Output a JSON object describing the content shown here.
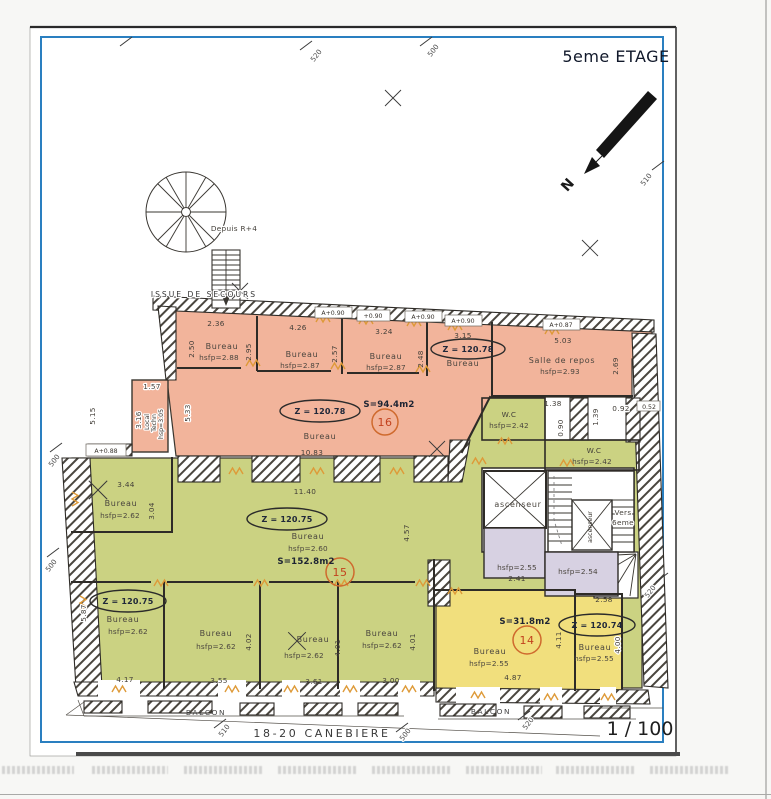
{
  "page": {
    "floor_title": "5eme ETAGE",
    "scale_label": "1 / 100",
    "street_label": "18-20 CANEBIERE",
    "north_label": "N",
    "issue_secours": "ISSUE DE SECOURS",
    "depuis_r4": "Depuis R+4"
  },
  "balcon": {
    "left": "BALCON",
    "right": "BALCON"
  },
  "grid": {
    "top_520": "520",
    "top_500": "500",
    "right_510": "510",
    "right_520": "520",
    "left_500_a": "500",
    "left_500_b": "500",
    "bottom_510": "510",
    "bottom_500": "500",
    "bottom_520": "520"
  },
  "zone16": {
    "z_big": "Z = 120.78",
    "z_small": "Z = 120.78",
    "area": "S=94.4m2",
    "num": "16",
    "big_name": "Bureau",
    "big_width": "10.83",
    "left_dim": "5.33",
    "wall_dim": "5.15",
    "a088": "A+0.88",
    "m1": "A+0.90",
    "m2": "+0.90",
    "m3": "A+0.90",
    "m4": "A+0.90",
    "m5": "A+0.87",
    "r1": {
      "name": "Bureau",
      "h": "hsfp=2.88",
      "w": "2.36",
      "d": "2.50"
    },
    "r2": {
      "name": "Bureau",
      "h": "hsfp=2.87",
      "w": "4.26",
      "d": "2.95",
      "d2": "2.57"
    },
    "r3": {
      "name": "Bureau",
      "h": "hsfp=2.87",
      "w": "3.24",
      "d": "2.48"
    },
    "r4": {
      "name": "Bureau",
      "w": "3.15"
    },
    "r5": {
      "name": "Salle de repos",
      "h": "hsfp=2.93",
      "w": "5.03",
      "d": "2.69"
    },
    "local": {
      "l1": "Local",
      "l2": "Techn",
      "l3": "hsp=3.05",
      "w": "1.57",
      "d": "3.16"
    }
  },
  "zone15": {
    "z": "Z = 120.75",
    "area": "S=152.8m2",
    "num": "15",
    "name": "Bureau",
    "h": "hsfp=2.60",
    "width": "11.40",
    "side": "4.57",
    "r344": {
      "w": "3.44",
      "name": "Bureau",
      "h": "hsfp=2.62",
      "d": "3.04"
    },
    "b1": {
      "z": "Z = 120.75",
      "name": "Bureau",
      "h": "hsfp=2.62",
      "d": "5.87",
      "w": "4.17"
    },
    "b2": {
      "name": "Bureau",
      "h": "hsfp=2.62",
      "d": "4.02",
      "w": "3.55"
    },
    "b3": {
      "name": "Bureau",
      "h": "hsfp=2.62",
      "d": "4.01",
      "w": "3.61"
    },
    "b4": {
      "name": "Bureau",
      "h": "hsfp=2.62",
      "d": "4.01",
      "w": "3.00"
    }
  },
  "wc": {
    "wc1_name": "W.C",
    "wc1_h": "hsfp=2.42",
    "wc2_name": "W.C",
    "wc2_h": "hsfp=2.42",
    "d138": "1.38",
    "d090": "0.90",
    "d139": "1.39",
    "d092": "0.92",
    "d052": "0.52"
  },
  "core": {
    "lift": "ascenseur",
    "lift2": "ascenseur",
    "vers_l1": "Vers",
    "vers_l2": "6eme",
    "lav1_h": "hsfp=2.55",
    "lav1_d": "2.41",
    "lav2_h": "hsfp=2.54"
  },
  "zone14": {
    "area": "S=31.8m2",
    "num": "14",
    "name": "Bureau",
    "h": "hsfp=2.55",
    "w": "4.87",
    "d": "4.11",
    "r_top": "2.58",
    "r_z": "Z = 120.74",
    "r_name": "Bureau",
    "r_h": "hsfp=2.55",
    "r_d": "4.00"
  },
  "colors": {
    "pink_zone": "#f2b49b",
    "green_zone": "#cbd282",
    "yellow_zone": "#f1df7d",
    "lavender_zone": "#d7d1e2",
    "blue_border": "#2a7fc0",
    "door_orange": "#de9a38",
    "room_number_red": "#c2411d"
  }
}
